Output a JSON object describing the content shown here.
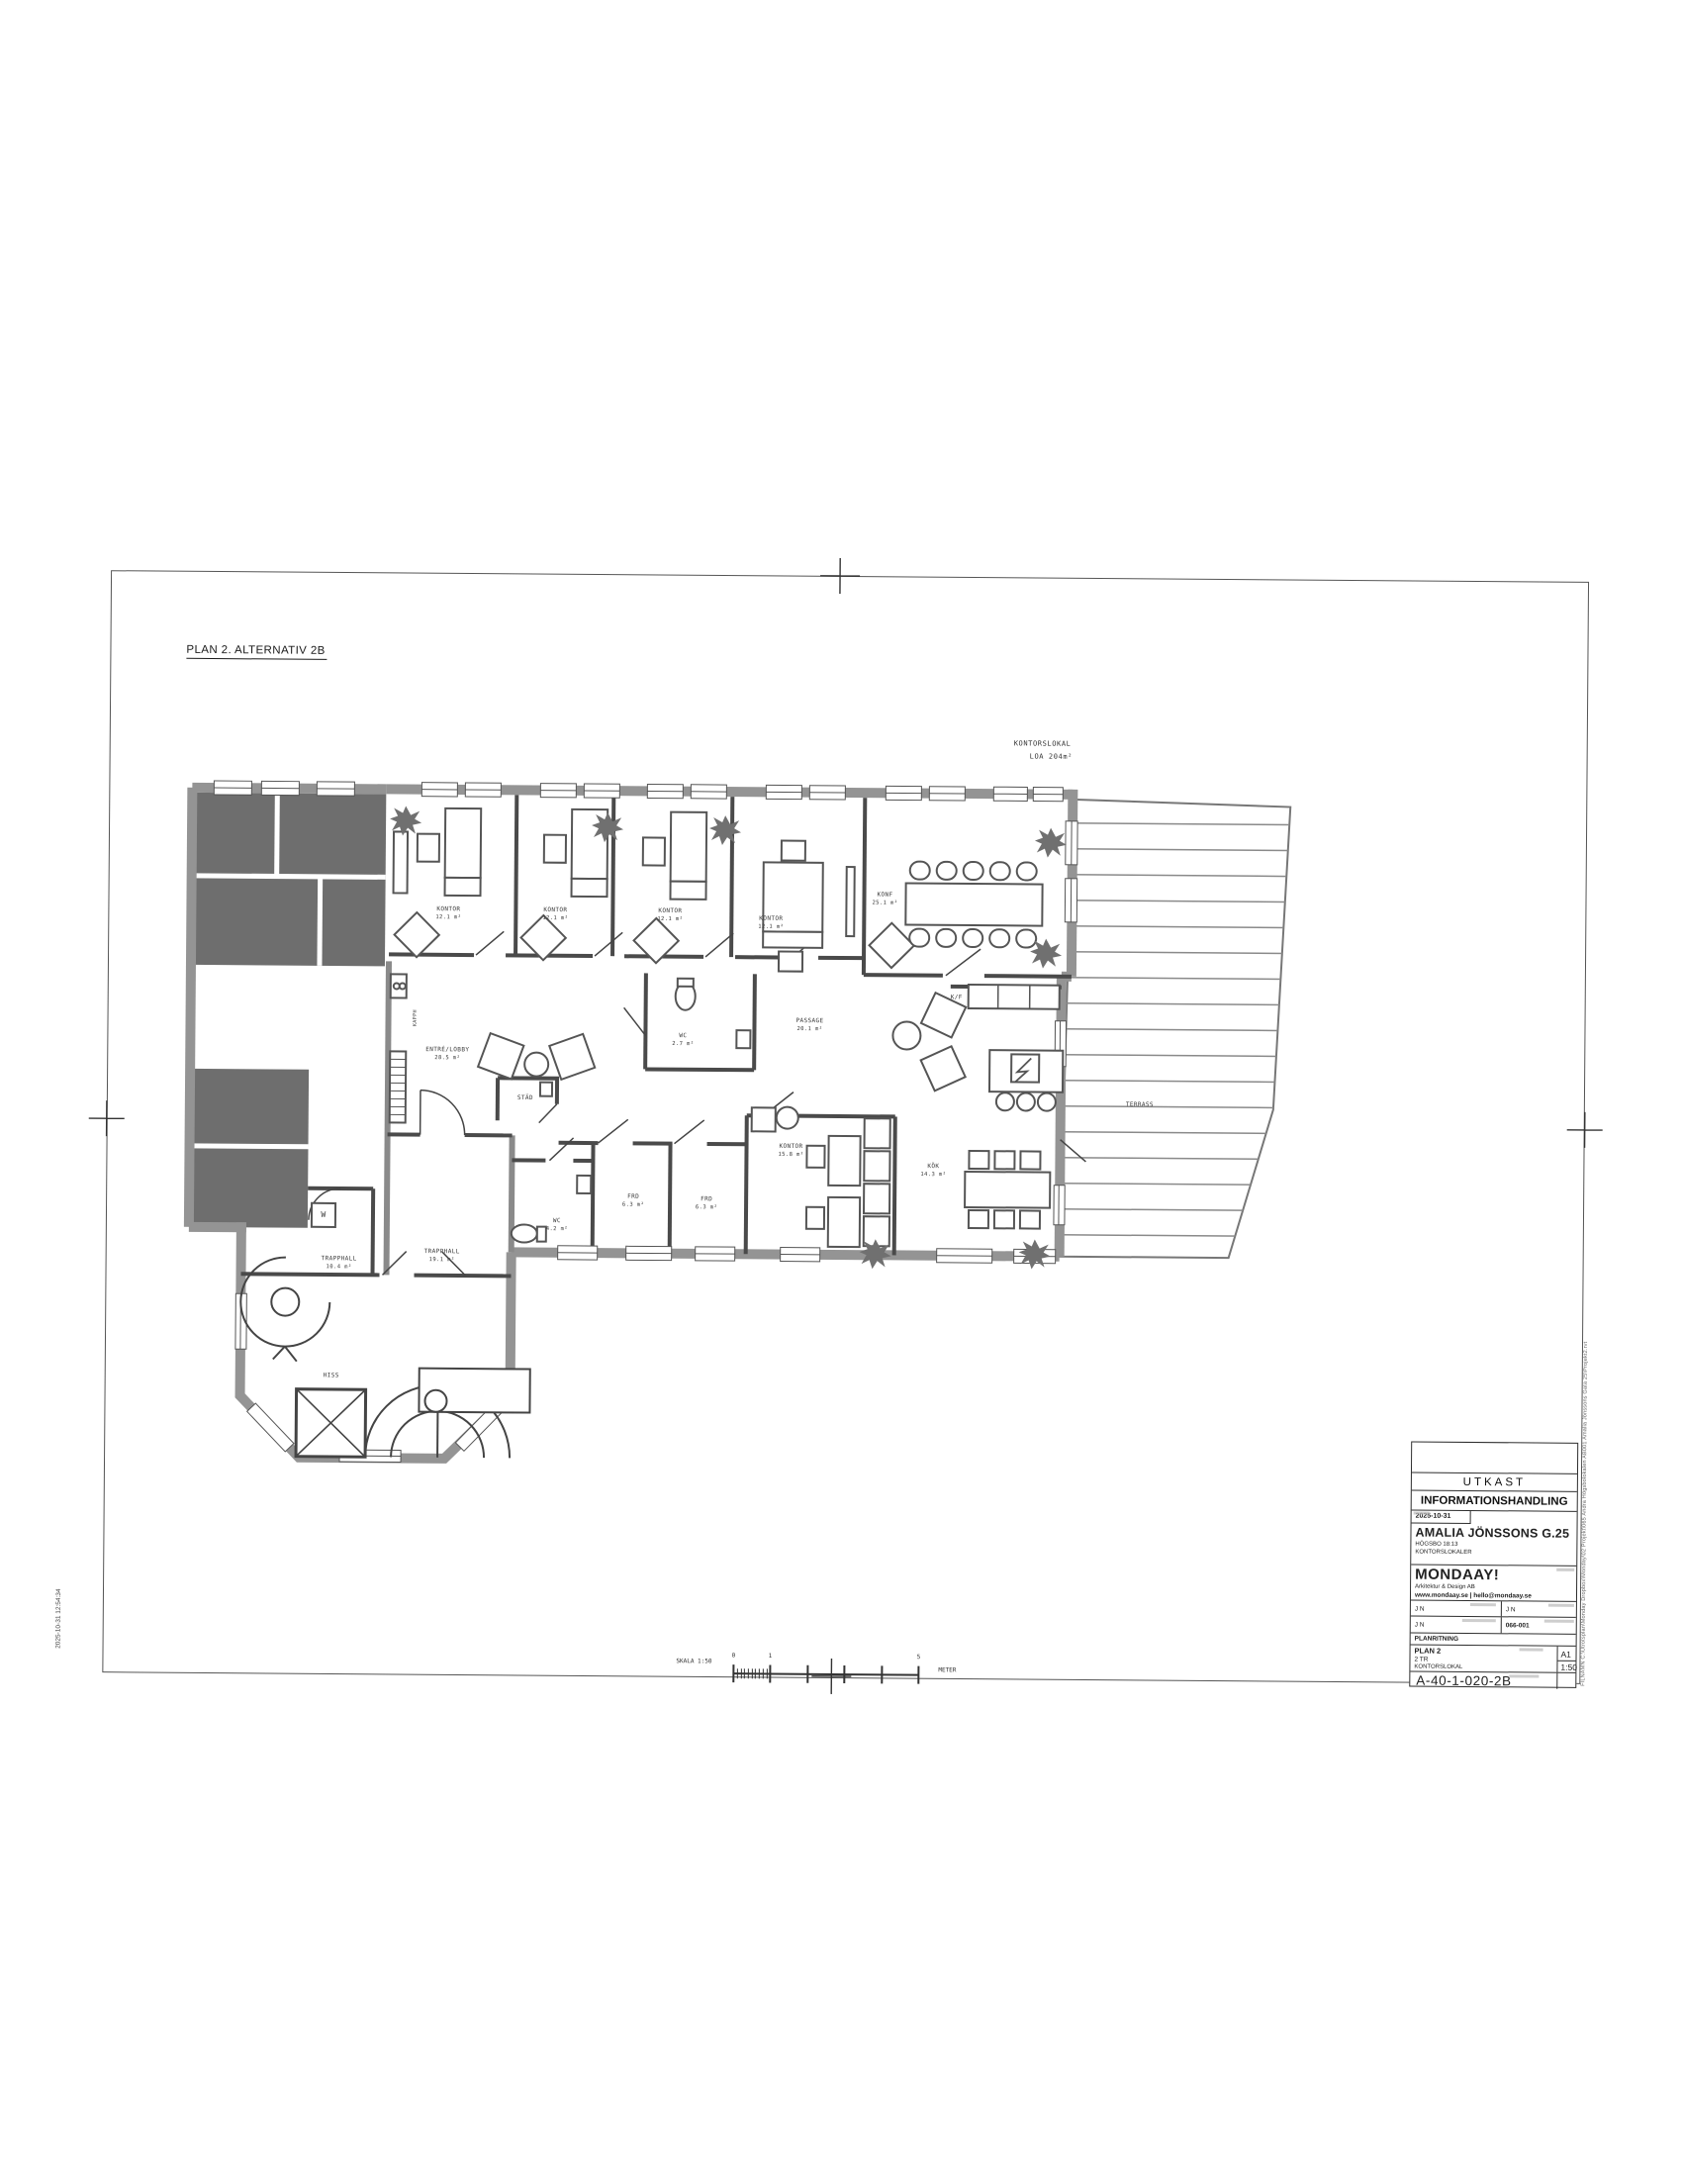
{
  "sheet": {
    "plan_title": "PLAN 2. ALTERNATIV 2B",
    "area_note": {
      "line1": "KONTORSLOKAL",
      "line2": "LOA 204m²"
    },
    "plot_stamp": "2025-10-31 12:54:34",
    "file_path": "FILNAMN C:\\Utrotsplan\\Monday Dropbox\\Monday\\02 Projekt\\065 Andra Högsbolokalen AB001 Amalia Jönssons Gata 25\\Projekt2.rvt"
  },
  "scale_bar": {
    "label": "SKALA 1:50",
    "tick_zero": "0",
    "tick_one": "1",
    "tick_five": "5",
    "unit": "METER"
  },
  "icons": {
    "kf": "K/F",
    "kapph": "KAPPH",
    "w": "W"
  },
  "rooms": [
    {
      "name": "KONTOR",
      "area": "12.1 m²"
    },
    {
      "name": "KONTOR",
      "area": "12.1 m²"
    },
    {
      "name": "KONTOR",
      "area": "12.1 m²"
    },
    {
      "name": "KONTOR",
      "area": "12.1 m²"
    },
    {
      "name": "KONF",
      "area": "25.1 m²"
    },
    {
      "name": "ENTRÉ/LOBBY",
      "area": "28.5 m²"
    },
    {
      "name": "STÄD",
      "area": ""
    },
    {
      "name": "WC",
      "area": "2.7 m²"
    },
    {
      "name": "PASSAGE",
      "area": "20.1 m²"
    },
    {
      "name": "KÖK",
      "area": "14.3 m²"
    },
    {
      "name": "TERRASS",
      "area": ""
    },
    {
      "name": "KONTOR",
      "area": "15.8 m²"
    },
    {
      "name": "FRD",
      "area": "6.3 m²"
    },
    {
      "name": "FRD",
      "area": "6.3 m²"
    },
    {
      "name": "WC",
      "area": "4.2 m²"
    },
    {
      "name": "TRAPPHALL",
      "area": "19.1 m²"
    },
    {
      "name": "TRAPPHALL",
      "area": "10.4 m²"
    },
    {
      "name": "HISS",
      "area": ""
    }
  ],
  "title_block": {
    "status": "UTKAST",
    "document_type": "INFORMATIONSHANDLING",
    "date": "2025-10-31",
    "project": "AMALIA JÖNSSONS G.25",
    "property": "HÖGSBO 18:13",
    "premises": "KONTORSLOKALER",
    "company": "MONDAAY!",
    "company_type": "Arkitektur & Design AB",
    "contact": "www.mondaay.se  |  hello@mondaay.se",
    "handler": "J N",
    "drawn_by": "J N",
    "approved_by": "J N",
    "project_number": "066-001",
    "drawing_category": "PLANRITNING",
    "content_line1": "PLAN 2",
    "content_line2": "2 TR",
    "content_line3": "KONTORSLOKAL",
    "format": "A1",
    "scale": "1:50",
    "drawing_number": "A-40-1-020-2B"
  }
}
